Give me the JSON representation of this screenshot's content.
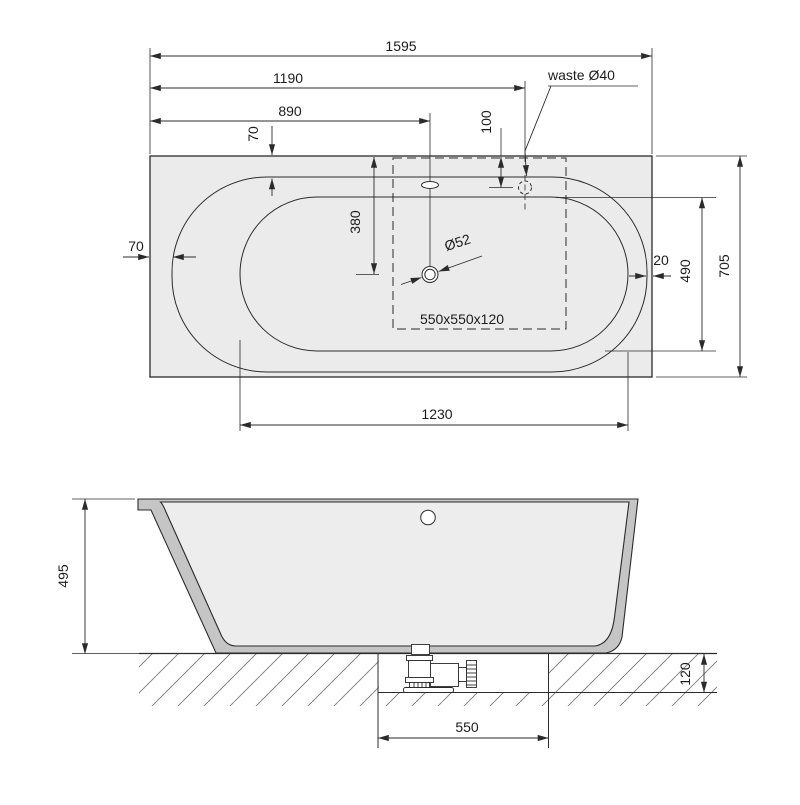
{
  "drawing": {
    "type": "technical-drawing-bathtub",
    "colors": {
      "background": "#ffffff",
      "line": "#2b2b2b",
      "text": "#1c1c1c",
      "deck": "#ebebeb",
      "wall": "#c5c5c5",
      "interior": "#ededed",
      "hatch": "#777777"
    },
    "plan": {
      "dims": {
        "total_length": "1595",
        "waste_x": "1190",
        "overflow_x": "890",
        "rim_top": "70",
        "waste_y": "100",
        "rim_left": "70",
        "drain_y": "380",
        "rim_right": "20",
        "basin_width_right": "490",
        "total_width": "705",
        "basin_length": "1230"
      },
      "labels": {
        "waste": "waste Ø40",
        "drain": "Ø52",
        "recess": "550x550x120"
      }
    },
    "side": {
      "dims": {
        "height": "495",
        "recess_depth": "120",
        "recess_width": "550"
      }
    }
  }
}
